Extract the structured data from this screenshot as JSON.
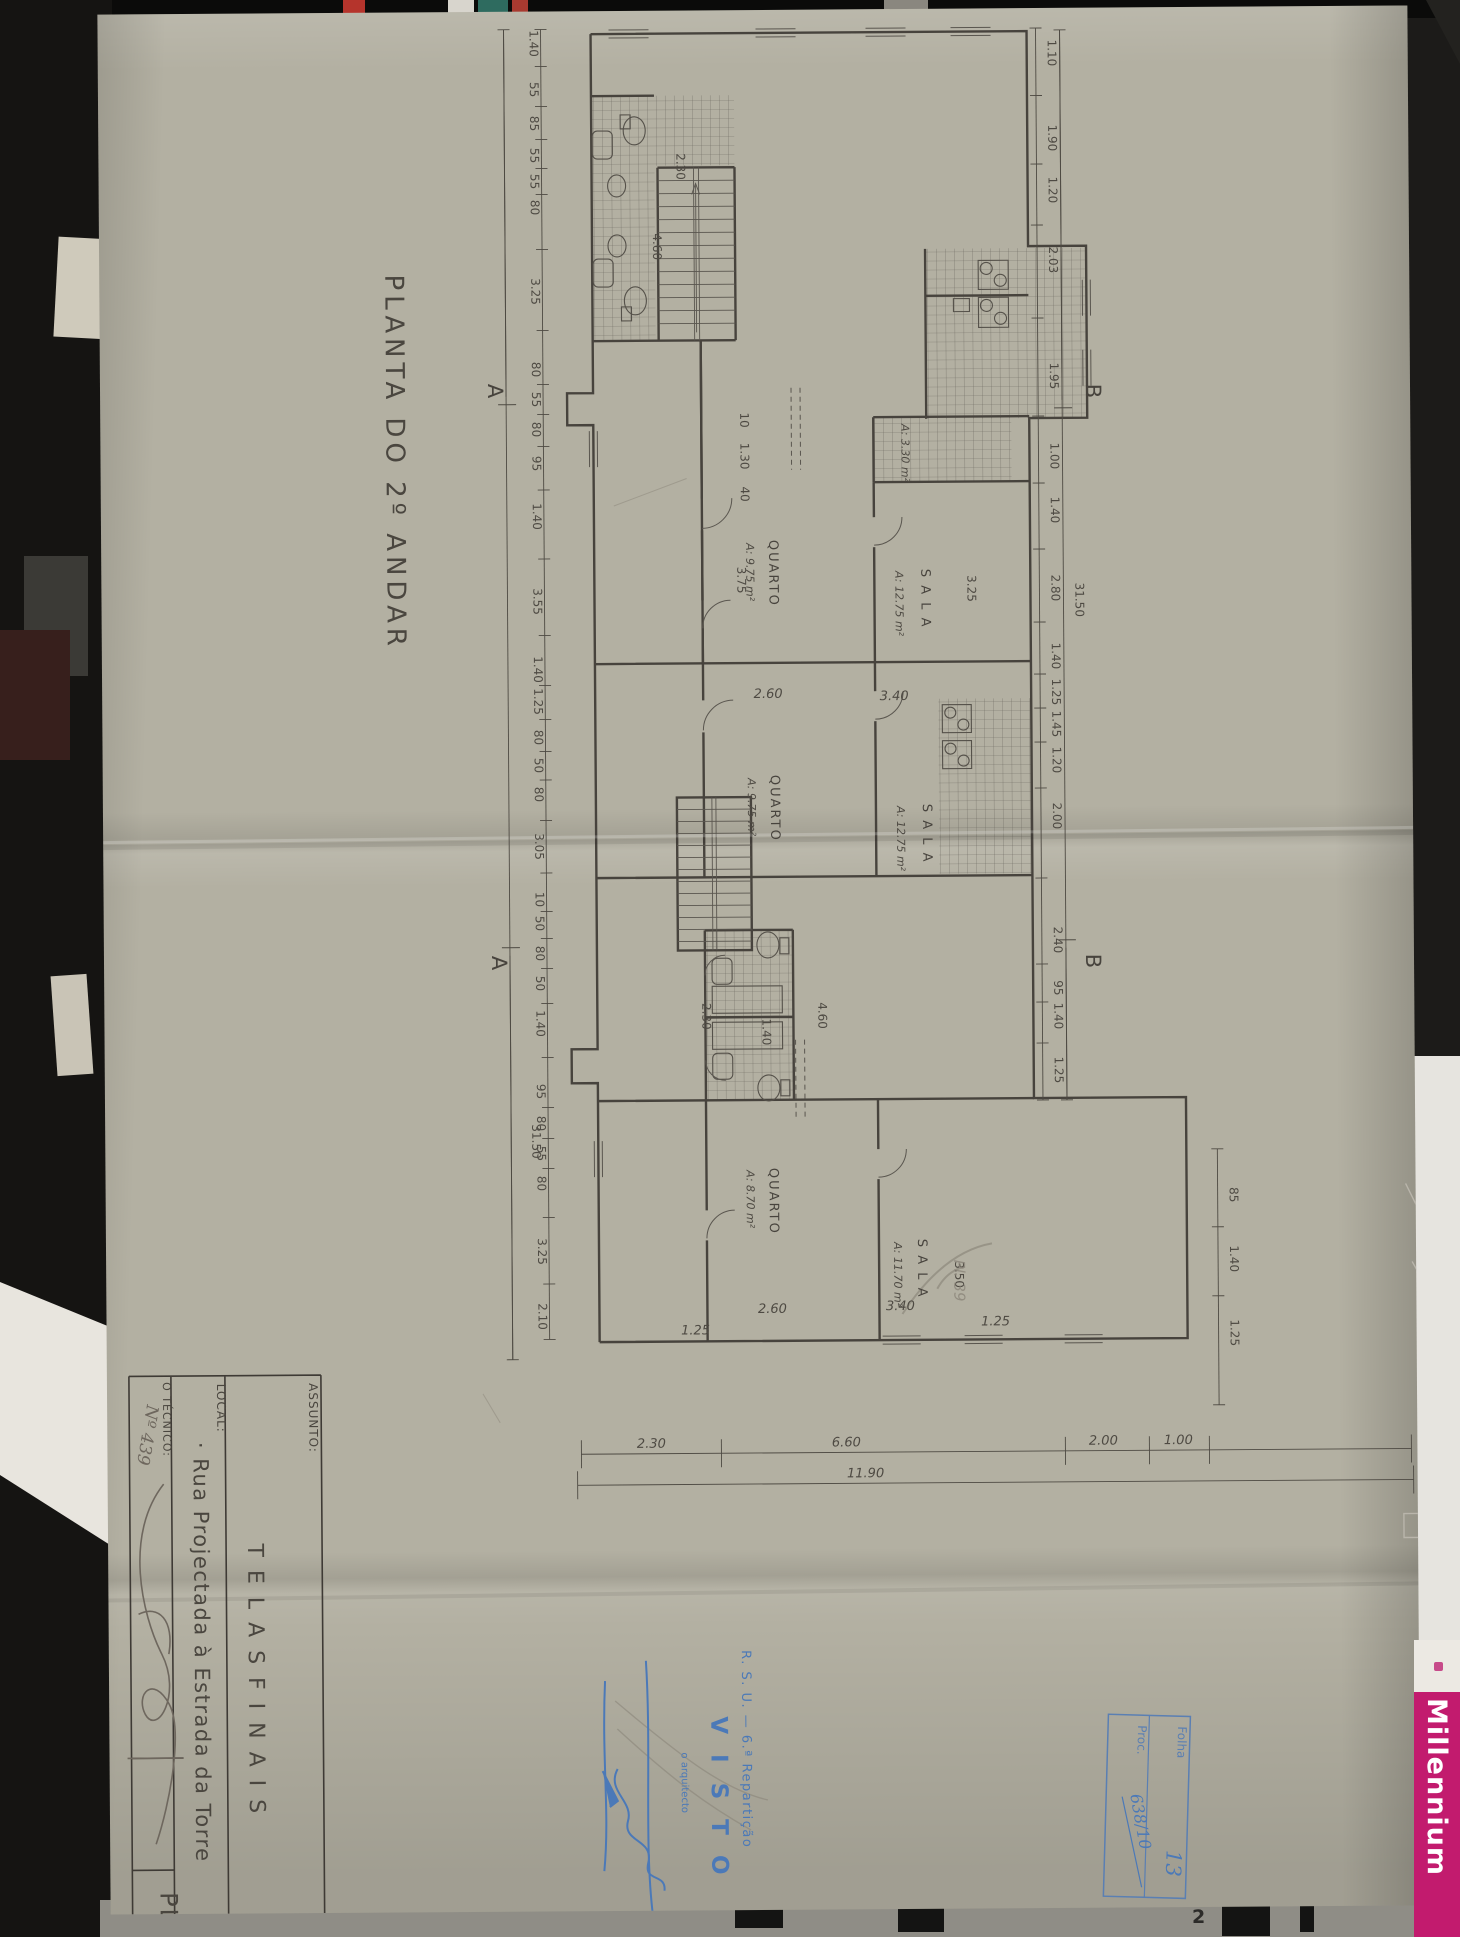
{
  "drawing": {
    "title": "PLANTA  DO  2º  ANDAR",
    "pencil_note": "Pl. 39",
    "sections": [
      {
        "label": "A",
        "x": 388,
        "y": 372
      },
      {
        "label": "A",
        "x": 388,
        "y": 944
      },
      {
        "label": "B",
        "x": 986,
        "y": 376
      },
      {
        "label": "B",
        "x": 982,
        "y": 946
      }
    ],
    "rooms": [
      {
        "name": "QUARTO",
        "area": "A: 9.75 m²",
        "x": 668,
        "y": 530,
        "ax": 645,
        "ay": 533
      },
      {
        "name": "S A L A",
        "area": "A: 12.75 m²",
        "x": 820,
        "y": 560,
        "ax": 794,
        "ay": 562
      },
      {
        "name": "QUARTO",
        "area": "A: 9.75 m²",
        "x": 668,
        "y": 765,
        "ax": 645,
        "ay": 768
      },
      {
        "name": "S A L A",
        "area": "A: 12.75 m²",
        "x": 820,
        "y": 795,
        "ax": 794,
        "ay": 797
      },
      {
        "name": "QUARTO",
        "area": "A: 8.70 m²",
        "x": 664,
        "y": 1158,
        "ax": 641,
        "ay": 1160
      },
      {
        "name": "S A L A",
        "area": "A: 11.70 m²",
        "x": 812,
        "y": 1230,
        "ax": 788,
        "ay": 1233
      },
      {
        "name": "",
        "area": "A: 3.30 m²",
        "x": 801,
        "y": 415
      }
    ],
    "chains": [
      {
        "id": "left",
        "orient": "v",
        "x": 443,
        "y1": 18,
        "y2": 1328,
        "tx": 432,
        "items": [
          {
            "y": 32,
            "v": "1.40"
          },
          {
            "y": 78,
            "v": "55"
          },
          {
            "y": 112,
            "v": "85"
          },
          {
            "y": 144,
            "v": "55"
          },
          {
            "y": 170,
            "v": "55"
          },
          {
            "y": 196,
            "v": "80"
          },
          {
            "y": 280,
            "v": "3.25"
          },
          {
            "y": 358,
            "v": "80"
          },
          {
            "y": 388,
            "v": "55"
          },
          {
            "y": 418,
            "v": "80"
          },
          {
            "y": 452,
            "v": "95"
          },
          {
            "y": 505,
            "v": "1.40"
          },
          {
            "y": 590,
            "v": "3.55"
          },
          {
            "y": 658,
            "v": "1.40"
          },
          {
            "y": 690,
            "v": "1.25"
          },
          {
            "y": 726,
            "v": "80"
          },
          {
            "y": 754,
            "v": "50"
          },
          {
            "y": 783,
            "v": "80"
          },
          {
            "y": 835,
            "v": "3.05"
          },
          {
            "y": 888,
            "v": "10"
          },
          {
            "y": 912,
            "v": "50"
          },
          {
            "y": 942,
            "v": "80"
          },
          {
            "y": 972,
            "v": "50"
          },
          {
            "y": 1012,
            "v": "1.40"
          },
          {
            "y": 1080,
            "v": "95"
          },
          {
            "y": 1112,
            "v": "80"
          },
          {
            "y": 1142,
            "v": "55"
          },
          {
            "y": 1172,
            "v": "80"
          },
          {
            "y": 1240,
            "v": "3.25"
          },
          {
            "y": 1305,
            "v": "2.10"
          }
        ]
      },
      {
        "id": "left-total",
        "orient": "v",
        "x": 406,
        "y1": 18,
        "y2": 1348,
        "tx": 427,
        "items": [
          {
            "y": 1130,
            "v": "31.50"
          }
        ]
      },
      {
        "id": "right",
        "orient": "v",
        "x": 938,
        "y1": 20,
        "y2": 1092,
        "tx": 950,
        "items": [
          {
            "y": 45,
            "v": "1.10"
          },
          {
            "y": 130,
            "v": "1.90"
          },
          {
            "y": 182,
            "v": "1.20"
          },
          {
            "y": 252,
            "v": "2.03"
          },
          {
            "y": 368,
            "v": "1.95"
          },
          {
            "y": 448,
            "v": "1.00"
          },
          {
            "y": 502,
            "v": "1.40"
          },
          {
            "y": 580,
            "v": "2.80"
          },
          {
            "y": 648,
            "v": "1.40"
          },
          {
            "y": 684,
            "v": "1.25"
          },
          {
            "y": 716,
            "v": "1.45"
          },
          {
            "y": 752,
            "v": "1.20"
          },
          {
            "y": 808,
            "v": "2.00"
          },
          {
            "y": 932,
            "v": "2.40"
          },
          {
            "y": 980,
            "v": "95"
          },
          {
            "y": 1008,
            "v": "1.40"
          },
          {
            "y": 1062,
            "v": "1.25"
          }
        ]
      },
      {
        "id": "right-total",
        "orient": "v",
        "x": 962,
        "y1": 22,
        "y2": 1092,
        "tx": 974,
        "items": [
          {
            "y": 592,
            "v": "31.50"
          }
        ]
      },
      {
        "id": "wing-right",
        "orient": "v",
        "x": 1112,
        "y1": 1142,
        "y2": 1398,
        "tx": 1124,
        "items": [
          {
            "y": 1188,
            "v": "85"
          },
          {
            "y": 1252,
            "v": "1.40"
          },
          {
            "y": 1326,
            "v": "1.25"
          }
        ]
      },
      {
        "id": "bottom-1",
        "orient": "h",
        "y": 1443,
        "x1": 474,
        "x2": 1304,
        "ty": 1437,
        "ticks": [
          474,
          614,
          958,
          1042,
          1102,
          1304
        ],
        "items": [
          {
            "x": 544,
            "v": "2.30"
          },
          {
            "x": 739,
            "v": "6.60"
          },
          {
            "x": 996,
            "v": "2.00"
          },
          {
            "x": 1071,
            "v": "1.00"
          }
        ]
      },
      {
        "id": "bottom-2",
        "orient": "h",
        "y": 1474,
        "x1": 470,
        "x2": 1306,
        "ty": 1468,
        "ticks": [
          470,
          1306
        ],
        "items": [
          {
            "x": 758,
            "v": "11.90"
          }
        ]
      }
    ],
    "dims": [
      {
        "x": 640,
        "y": 410,
        "v": "10",
        "rot": true
      },
      {
        "x": 640,
        "y": 446,
        "v": "1.30",
        "rot": true
      },
      {
        "x": 640,
        "y": 484,
        "v": "40",
        "rot": true
      },
      {
        "x": 636,
        "y": 570,
        "v": "3.75",
        "rot": true
      },
      {
        "x": 866,
        "y": 580,
        "v": "3.25",
        "rot": true
      },
      {
        "x": 554,
        "y": 236,
        "v": "4.60",
        "rot": true
      },
      {
        "x": 578,
        "y": 156,
        "v": "2.30",
        "rot": true
      },
      {
        "x": 714,
        "y": 1006,
        "v": "4.60",
        "rot": true
      },
      {
        "x": 598,
        "y": 1006,
        "v": "2.30",
        "rot": true
      },
      {
        "x": 658,
        "y": 1022,
        "v": "1.40",
        "rot": true
      },
      {
        "x": 849,
        "y": 1266,
        "v": "3.50",
        "rot": true
      },
      {
        "x": 666,
        "y": 688,
        "v": "2.60"
      },
      {
        "x": 792,
        "y": 691,
        "v": "3.40"
      },
      {
        "x": 666,
        "y": 1303,
        "v": "2.60"
      },
      {
        "x": 794,
        "y": 1301,
        "v": "3.40"
      },
      {
        "x": 589,
        "y": 1324,
        "v": "1.25"
      },
      {
        "x": 889,
        "y": 1317,
        "v": "1.25"
      }
    ]
  },
  "title_block": {
    "assunto_label": "ASSUNTO:",
    "assunto_value": "T E L A S     F I N A I S",
    "local_label": "LOCAL:",
    "local_value": "· Rua  Projectada  à  Estrada  da  Torre",
    "tecnico_label": "O TÉCNICO:",
    "tecnico_number": "Nº 439",
    "sheet_code": "PL"
  },
  "stamps": {
    "visto": {
      "line1": "R. S. U. — 6.ª Repartição",
      "line2": "V I S T O",
      "line3": "o arquitecto"
    },
    "registry": {
      "folha_label": "Folha",
      "proc_label": "Proc.",
      "folha_value": "13",
      "proc_value": "638/10"
    }
  },
  "photo": {
    "brand_label": "Millennium",
    "bottom_mark": "2"
  },
  "colors": {
    "paper": "#b3b0a2",
    "ink": "#47433d",
    "dim_text": "#4e4a43",
    "stamp_blue": "#4b79b8",
    "brand_magenta": "#c21b6e",
    "pencil": "#8b857a"
  }
}
